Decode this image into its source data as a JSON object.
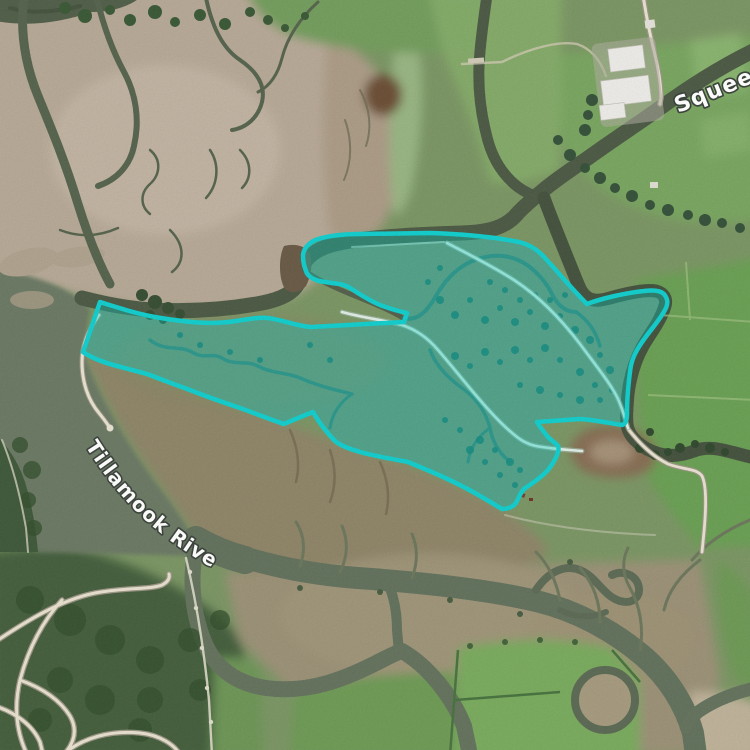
{
  "map": {
    "labels": {
      "river": "Tillamook River",
      "slough": "Squeed"
    },
    "label_style": {
      "text_color": "#ffffff",
      "halo_color": "#3b423c"
    },
    "highlight": {
      "stroke_color": "#0fd5d5",
      "fill_color": "rgba(0,216,206,0.34)"
    }
  }
}
